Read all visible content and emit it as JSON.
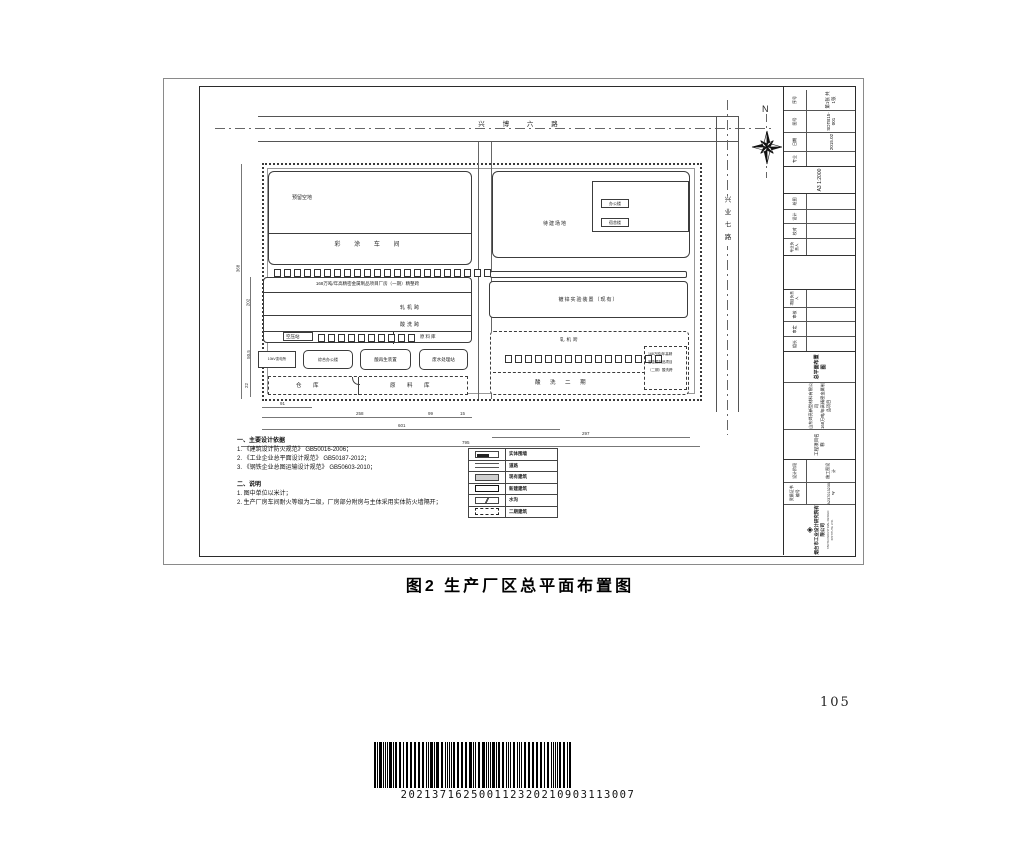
{
  "page": {
    "caption": "图2  生产厂区总平面布置图",
    "number": "105"
  },
  "barcode": {
    "digits": "202137162500112320210903113007"
  },
  "north": {
    "label": "N"
  },
  "roads": {
    "top": "兴 博 六 路",
    "right": "兴业七路"
  },
  "plan": {
    "labels": {
      "reserved": "预留空地",
      "paint_shop": "彩 涂 车 间",
      "main_plant": "168万吨/年高精密金属制品项目厂房（一期）精整跨",
      "mill_bay": "轧机跨",
      "pickling_bay": "酸洗跨",
      "air_station": "空压站",
      "raw_store": "原料库",
      "substation": "10kV变电所",
      "office_complex": "综合办公楼",
      "acid_regen": "酸再生装置",
      "wastewater": "废水处理站",
      "warehouse": "仓 库",
      "raw_warehouse": "原 料 库",
      "future_site": "待建场地",
      "office": "办公楼",
      "dorm": "宿舍楼",
      "galv_test": "镀锌实验装置（现有）",
      "mill_bay2": "轧机跨",
      "pickling_phase2": "酸 洗 二 期",
      "p2_line1": "168万吨/年高精",
      "p2_line2": "密金属制品项目",
      "p2_line3": "（二期）酸洗跨"
    },
    "dims_bottom": [
      "91",
      "258",
      "99",
      "15",
      "601",
      "297",
      "795"
    ],
    "dims_left": [
      "368",
      "202",
      "50.5",
      "22"
    ]
  },
  "legend": {
    "items": [
      {
        "label": "实体围墙"
      },
      {
        "label": "道路"
      },
      {
        "label": "现有建筑"
      },
      {
        "label": "新建建筑"
      },
      {
        "label": "水沟"
      },
      {
        "label": "二期建筑"
      }
    ]
  },
  "notes": {
    "h1": "一、主要设计依据",
    "l1": "1. 《建筑设计防火规范》 GB50016-2006；",
    "l2": "2. 《工业企业总平面设计规范》 GB50187-2012；",
    "l3": "3. 《钢铁企业总图运输设计规范》 GB50603-2010；",
    "h2": "二、说明",
    "m1": "1. 图中单位以米计；",
    "m2": "2. 生产厂房车间耐火等级为二级，厂房部分附房与主体采用实体防火墙隔开；"
  },
  "titleblock": {
    "fields": [
      {
        "label": "专业",
        "value": ""
      },
      {
        "label": "日期",
        "value": "2015.02"
      },
      {
        "label": "图号",
        "value": "SDTB15-001"
      },
      {
        "label": "序号",
        "value": "第1张 共1张"
      }
    ],
    "scale": "A3 1:2000",
    "sig1": [
      "专业负责人",
      "校对",
      "设计",
      "绘图"
    ],
    "sig2": [
      "组长",
      "审定",
      "审核",
      "项目负责人"
    ],
    "project": {
      "label": "工程项目名称",
      "owner": "山东烨亮新型材料有限公司",
      "name": "168万吨/年高精密金属制品项目",
      "drawing": "总平面布置图"
    },
    "company": {
      "name": "烟台市工业设计研究院有限公司",
      "en": "YANTAI INDUSTRIAL DESIGN INSTITUTE LTD.",
      "cert_label": "资质证书编号",
      "cert_value": "A237013230-sy",
      "stage_label": "设计阶段",
      "stage_value": "施工图设计"
    }
  }
}
